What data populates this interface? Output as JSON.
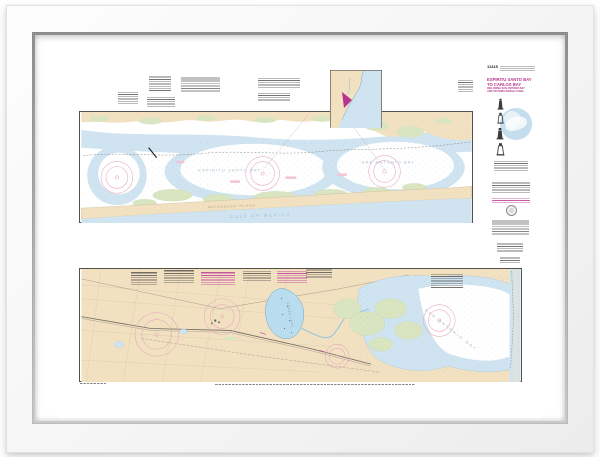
{
  "chart": {
    "number": "11315",
    "title_block": {
      "title_line1": "ESPIRITU SANTO BAY",
      "title_line2": "TO CARLOS BAY",
      "subtitle_line1": "INCLUDING SAN ANTONIO BAY",
      "subtitle_line2": "AND VICTORIA BARGE CANAL"
    },
    "labels": {
      "top_bay_center": "ESPIRITU SANTO BAY",
      "top_bay_right": "SAN ANTONIO BAY",
      "island": "MATAGORDA ISLAND",
      "gulf": "GULF OF MEXICO",
      "bottom_bay": "SAN ANTONIO BAY",
      "lake": "GREEN LAKE"
    },
    "colors": {
      "land": "#f2e1c1",
      "marsh": "#d9e4c1",
      "shallow_water": "#cfe4f0",
      "deep_water": "#ffffff",
      "compass_rose": "#e5a4bd",
      "chart_magenta": "#b5348f",
      "neatline": "#54514a",
      "frame": "#f6f6f6",
      "frame_lip": "#aaaaaa",
      "mat": "#ffffff"
    }
  }
}
